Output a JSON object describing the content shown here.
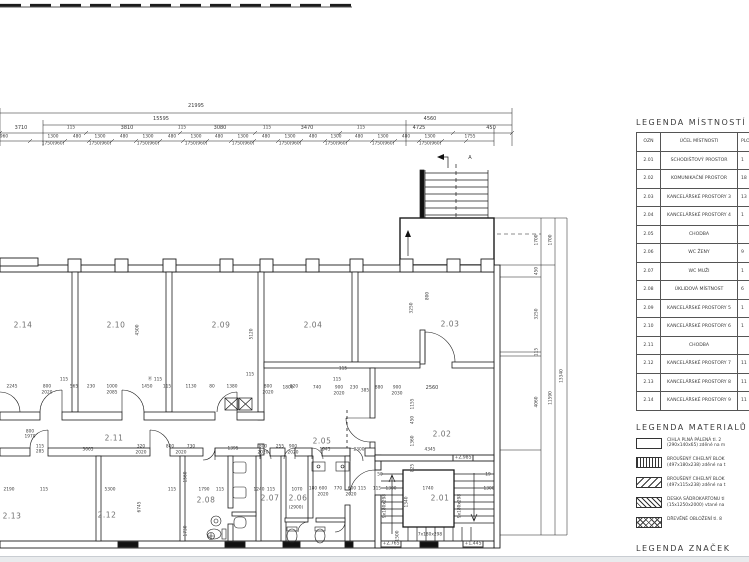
{
  "legend_rooms": {
    "title": "LEGENDA MÍSTNOSTÍ",
    "headers": [
      "OZN",
      "ÚČEL MÍSTNOSTI",
      "PLO"
    ],
    "rows": [
      [
        "2.01",
        "SCHODIŠŤOVÝ PROSTOR",
        "1"
      ],
      [
        "2.02",
        "KOMUNIKAČNÍ PROSTOR",
        "18"
      ],
      [
        "2.03",
        "KANCELÁŘSKÉ PROSTORY 3",
        "13"
      ],
      [
        "2.04",
        "KANCELÁŘSKÉ PROSTORY 4",
        "1"
      ],
      [
        "2.05",
        "CHODBA",
        ""
      ],
      [
        "2.06",
        "WC ŽENY",
        "9"
      ],
      [
        "2.07",
        "WC MUŽI",
        "1"
      ],
      [
        "2.08",
        "ÚKLIDOVÁ MÍSTNOST",
        "6"
      ],
      [
        "2.09",
        "KANCELÁŘSKÉ PROSTORY 5",
        "1"
      ],
      [
        "2.10",
        "KANCELÁŘSKÉ PROSTORY 6",
        "1"
      ],
      [
        "2.11",
        "CHODBA",
        ""
      ],
      [
        "2.12",
        "KANCELÁŘSKÉ PROSTORY 7",
        "11"
      ],
      [
        "2.13",
        "KANCELÁŘSKÉ PROSTORY 8",
        "11"
      ],
      [
        "2.14",
        "KANCELÁŘSKÉ PROSTORY 9",
        "11"
      ]
    ]
  },
  "legend_materials": {
    "title": "LEGENDA MATERIALŮ",
    "items": [
      {
        "pattern": "solid",
        "line1": "CIHLA PLNÁ PÁLENÁ tl. 2",
        "line2": "(290x140x65) zděné na m"
      },
      {
        "pattern": "vlines",
        "line1": "BROUŠENÝ CIHELNÝ BLOK",
        "line2": "(497x180x238) zděné na t"
      },
      {
        "pattern": "diagwide",
        "line1": "BROUŠENÝ CIHELNÝ BLOK",
        "line2": "(497x115x238) zděné na t"
      },
      {
        "pattern": "diagdense",
        "line1": "DESKA SÁDROKARTONU tl",
        "line2": "(15x1250x2000) vtané na"
      },
      {
        "pattern": "cross",
        "line1": "DŘEVĚNÉ OBLOŽENÍ tl. 8",
        "line2": ""
      }
    ]
  },
  "legend_symbols": {
    "title": "LEGENDA ZNAČEK"
  },
  "plan": {
    "room_labels": [
      {
        "id": "2.14",
        "x": 23,
        "y": 325
      },
      {
        "id": "2.10",
        "x": 116,
        "y": 325
      },
      {
        "id": "2.09",
        "x": 221,
        "y": 325
      },
      {
        "id": "2.04",
        "x": 313,
        "y": 325
      },
      {
        "id": "2.03",
        "x": 450,
        "y": 324
      },
      {
        "id": "2.11",
        "x": 114,
        "y": 438
      },
      {
        "id": "2.05",
        "x": 322,
        "y": 441
      },
      {
        "id": "2.02",
        "x": 442,
        "y": 434
      },
      {
        "id": "2.13",
        "x": 12,
        "y": 516
      },
      {
        "id": "2.12",
        "x": 107,
        "y": 515
      },
      {
        "id": "2.08",
        "x": 206,
        "y": 500
      },
      {
        "id": "2.07",
        "x": 270,
        "y": 498
      },
      {
        "id": "2.06",
        "x": 298,
        "y": 498
      },
      {
        "id": "2.01",
        "x": 440,
        "y": 498
      }
    ],
    "dim_labels": [
      [
        "21995",
        196,
        106
      ],
      [
        "15595",
        161,
        119
      ],
      [
        "4560",
        430,
        119
      ],
      [
        "3710",
        21,
        128
      ],
      [
        "115",
        71,
        128,
        "s"
      ],
      [
        "3810",
        127,
        128
      ],
      [
        "115",
        182,
        128,
        "s"
      ],
      [
        "3080",
        220,
        128
      ],
      [
        "115",
        267,
        128,
        "s"
      ],
      [
        "3470",
        307,
        128
      ],
      [
        "115",
        361,
        128,
        "s"
      ],
      [
        "4725",
        419,
        128
      ],
      [
        "450",
        491,
        128
      ],
      [
        "960",
        4,
        137,
        "s"
      ],
      [
        "1300",
        53,
        137,
        "s"
      ],
      [
        "1750(960)",
        53,
        144,
        "s"
      ],
      [
        "480",
        77,
        137,
        "s"
      ],
      [
        "1300",
        100,
        137,
        "s"
      ],
      [
        "1750(960)",
        100,
        144,
        "s"
      ],
      [
        "480",
        124,
        137,
        "s"
      ],
      [
        "1300",
        148,
        137,
        "s"
      ],
      [
        "1750(960)",
        148,
        144,
        "s"
      ],
      [
        "480",
        172,
        137,
        "s"
      ],
      [
        "1300",
        196,
        137,
        "s"
      ],
      [
        "1750(960)",
        196,
        144,
        "s"
      ],
      [
        "480",
        219,
        137,
        "s"
      ],
      [
        "1300",
        243,
        137,
        "s"
      ],
      [
        "1750(960)",
        243,
        144,
        "s"
      ],
      [
        "480",
        266,
        137,
        "s"
      ],
      [
        "1300",
        290,
        137,
        "s"
      ],
      [
        "1750(960)",
        290,
        144,
        "s"
      ],
      [
        "480",
        313,
        137,
        "s"
      ],
      [
        "1300",
        336,
        137,
        "s"
      ],
      [
        "1750(960)",
        336,
        144,
        "s"
      ],
      [
        "480",
        359,
        137,
        "s"
      ],
      [
        "1300",
        383,
        137,
        "s"
      ],
      [
        "1750(960)",
        383,
        144,
        "s"
      ],
      [
        "480",
        406,
        137,
        "s"
      ],
      [
        "1300",
        430,
        137,
        "s"
      ],
      [
        "1750(960)",
        430,
        144,
        "s"
      ],
      [
        "1755",
        470,
        137,
        "s"
      ],
      [
        "1700",
        537,
        240,
        "r"
      ],
      [
        "1700",
        551,
        240,
        "r"
      ],
      [
        "450",
        537,
        271,
        "r"
      ],
      [
        "3250",
        537,
        314,
        "r"
      ],
      [
        "115",
        537,
        352,
        "r"
      ],
      [
        "4060",
        537,
        402,
        "r"
      ],
      [
        "11590",
        551,
        398,
        "r"
      ],
      [
        "13340",
        562,
        376,
        "r"
      ],
      [
        "4500",
        138,
        330,
        "r"
      ],
      [
        "5120",
        252,
        334,
        "r"
      ],
      [
        "3250",
        412,
        308,
        "r"
      ],
      [
        "800",
        428,
        296,
        "r"
      ],
      [
        "115",
        64,
        380,
        "s"
      ],
      [
        "115",
        158,
        380,
        "s"
      ],
      [
        "115",
        250,
        375,
        "s"
      ],
      [
        "115",
        343,
        369,
        "s"
      ],
      [
        "2245",
        12,
        387,
        "s"
      ],
      [
        "800",
        47,
        387,
        "s"
      ],
      [
        "2020",
        47,
        393,
        "s"
      ],
      [
        "565",
        74,
        387,
        "s"
      ],
      [
        "230",
        91,
        387,
        "s"
      ],
      [
        "1000",
        112,
        387,
        "s"
      ],
      [
        "2085",
        112,
        393,
        "s"
      ],
      [
        "1450",
        147,
        387,
        "s"
      ],
      [
        "Ⓚ",
        150,
        379,
        "s"
      ],
      [
        "115",
        167,
        387,
        "s"
      ],
      [
        "1130",
        191,
        387,
        "s"
      ],
      [
        "80",
        212,
        387,
        "s"
      ],
      [
        "1380",
        232,
        387,
        "s"
      ],
      [
        "800",
        268,
        387,
        "s"
      ],
      [
        "2020",
        268,
        393,
        "s"
      ],
      [
        "820",
        294,
        387,
        "s"
      ],
      [
        "115",
        337,
        380,
        "s"
      ],
      [
        "1800",
        288,
        388,
        "s"
      ],
      [
        "740",
        317,
        388,
        "s"
      ],
      [
        "900",
        339,
        388,
        "s"
      ],
      [
        "2020",
        339,
        394,
        "s"
      ],
      [
        "230",
        354,
        388,
        "s"
      ],
      [
        "385",
        365,
        391,
        "s"
      ],
      [
        "880",
        379,
        388,
        "s"
      ],
      [
        "900",
        397,
        388,
        "s"
      ],
      [
        "2030",
        397,
        394,
        "s"
      ],
      [
        "2560",
        432,
        388
      ],
      [
        "1155",
        413,
        404,
        "r"
      ],
      [
        "450",
        413,
        420,
        "r"
      ],
      [
        "1360",
        413,
        441,
        "r"
      ],
      [
        "825",
        413,
        468,
        "r"
      ],
      [
        "800",
        30,
        432,
        "s"
      ],
      [
        "1970",
        30,
        437,
        "s"
      ],
      [
        "115",
        40,
        447,
        "s"
      ],
      [
        "285",
        40,
        452,
        "s"
      ],
      [
        "3665",
        88,
        450,
        "s"
      ],
      [
        "320",
        141,
        447,
        "s"
      ],
      [
        "2020",
        141,
        453,
        "s"
      ],
      [
        "800",
        170,
        447,
        "s"
      ],
      [
        "730",
        191,
        447,
        "s"
      ],
      [
        "2020",
        181,
        453,
        "s"
      ],
      [
        "1395",
        233,
        449,
        "s"
      ],
      [
        "800",
        263,
        447,
        "s"
      ],
      [
        "2020",
        263,
        453,
        "s"
      ],
      [
        "255",
        280,
        447,
        "s"
      ],
      [
        "900",
        293,
        447,
        "s"
      ],
      [
        "2020",
        293,
        453,
        "s"
      ],
      [
        "1945",
        325,
        450,
        "s"
      ],
      [
        "2300",
        359,
        450,
        "s"
      ],
      [
        "4345",
        430,
        450,
        "s"
      ],
      [
        "2190",
        9,
        490,
        "s"
      ],
      [
        "115",
        44,
        490,
        "s"
      ],
      [
        "5300",
        110,
        490,
        "s"
      ],
      [
        "115",
        172,
        490,
        "s"
      ],
      [
        "1790",
        204,
        490,
        "s"
      ],
      [
        "115",
        220,
        490,
        "s"
      ],
      [
        "6745",
        140,
        507,
        "r"
      ],
      [
        "1560",
        186,
        477,
        "r"
      ],
      [
        "1730",
        186,
        531,
        "r"
      ],
      [
        "1240",
        259,
        490,
        "s"
      ],
      [
        "115",
        271,
        490,
        "s"
      ],
      [
        "1070",
        297,
        490,
        "s"
      ],
      [
        "180",
        313,
        489,
        "s"
      ],
      [
        "600",
        323,
        489,
        "s"
      ],
      [
        "770",
        338,
        489,
        "s"
      ],
      [
        "600",
        352,
        489,
        "s"
      ],
      [
        "115",
        362,
        489,
        "s"
      ],
      [
        "2020",
        323,
        495,
        "s"
      ],
      [
        "2020",
        351,
        495,
        "s"
      ],
      [
        "50",
        380,
        475,
        "s"
      ],
      [
        "19",
        488,
        475,
        "s"
      ],
      [
        "115",
        377,
        489,
        "s"
      ],
      [
        "1300",
        391,
        489,
        "s"
      ],
      [
        "1740",
        428,
        489,
        "s"
      ],
      [
        "1300",
        489,
        489,
        "s"
      ],
      [
        "1340",
        407,
        502,
        "r"
      ],
      [
        "9x180x298",
        385,
        506,
        "r"
      ],
      [
        "9x180x298",
        460,
        506,
        "r"
      ],
      [
        "1500",
        398,
        536,
        "r"
      ],
      [
        "7x180x298",
        430,
        535,
        "s"
      ],
      [
        "A",
        470,
        158
      ],
      [
        "(2900)",
        296,
        508,
        "s"
      ],
      [
        "+2,985",
        463,
        458,
        "b"
      ],
      [
        "+2,765",
        391,
        544,
        "b"
      ],
      [
        "+1,445",
        473,
        544,
        "b"
      ]
    ]
  }
}
